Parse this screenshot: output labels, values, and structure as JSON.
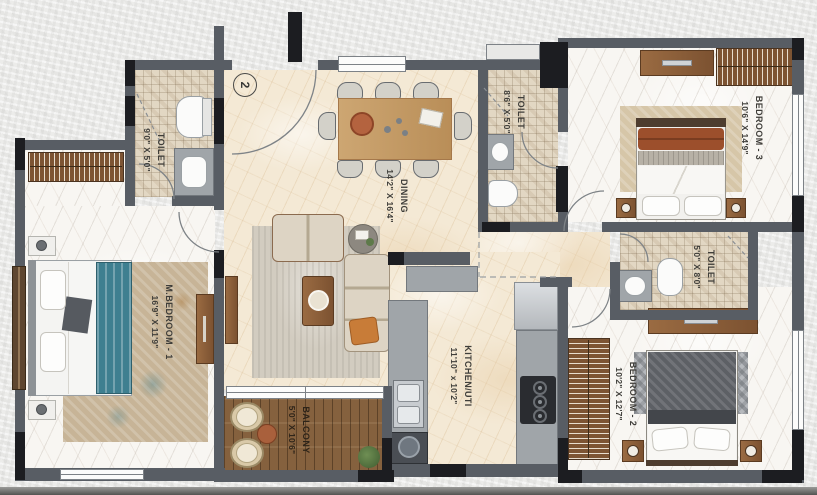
{
  "plan_title": "apartment-floor-plan",
  "entrance": {
    "door_number": "2"
  },
  "rooms": {
    "master_toilet": {
      "name": "TOILET",
      "dims": "9'0\" X 5'0\""
    },
    "dining": {
      "name": "DINING",
      "dims": "14'2\" X 16'4\""
    },
    "common_toilet": {
      "name": "TOILET",
      "dims": "8'6\" X 5'0\""
    },
    "bedroom3": {
      "name": "BEDROOM - 3",
      "dims": "10'6\" X 14'9\""
    },
    "toilet_right": {
      "name": "TOILET",
      "dims": "5'0\" X 8'0\""
    },
    "bedroom2": {
      "name": "BEDROOM - 2",
      "dims": "10'2\" X 12'7\""
    },
    "master_bedroom": {
      "name": "M.BEDROOM - 1",
      "dims": "16'9\" X 11'9\""
    },
    "kitchen": {
      "name": "KITCHEN/UTI",
      "dims": "11'10\" x 10'2\""
    },
    "balcony": {
      "name": "BALCONY",
      "dims": "5'0\" X 10'6\""
    }
  },
  "colors": {
    "wall": "#585d64",
    "wall_dark": "#1c1d21",
    "floor_cream": "#f4e9d5",
    "floor_marble": "#f8f6f2",
    "floor_tile": "#e2d7c3",
    "balcony_deck": "#85613e",
    "wood_furniture": "#8a5f3c",
    "accent_teal": "#3e7f90",
    "accent_rust": "#9c4f2c"
  }
}
